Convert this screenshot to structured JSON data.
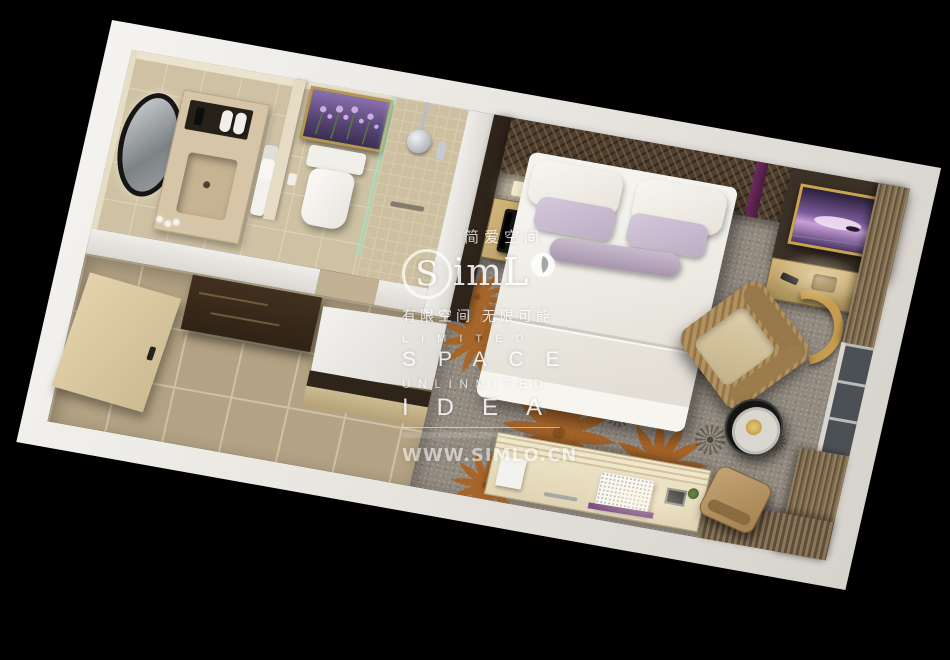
{
  "scene": {
    "type": "3d-top-down-floorplan-render",
    "subject": "hotel guest room with bathroom, entry corridor and bedroom",
    "background_color": "#000000"
  },
  "watermark": {
    "chinese_title": "简爱空间",
    "logo": {
      "part1": "S",
      "part2": "imL"
    },
    "chinese_tagline": "有限空间 无限可能",
    "english_lines": {
      "line1": "LIMITED",
      "line2": "SPACE",
      "line3": "UNLINMITED",
      "line4": "IDEA"
    },
    "website": "WWW.SIMLO.CN"
  },
  "palette": {
    "background": "#000000",
    "outer_wall": "#e9e6e1",
    "bathroom_floor": "#cfc2a4",
    "corridor_floor": "#b3a283",
    "carpet": "#928a7f",
    "dark_wood": "#37291c",
    "gold_brass": "#c3a768",
    "bedding_white": "#f3f1ec",
    "pillow_mauve": "#cbbccf",
    "accent_purple": "#6e2b5e",
    "curtain_brown": "#7d6a4f",
    "flower_orange": "#ad5e17",
    "artwork_lavender": "#8a6fae"
  }
}
